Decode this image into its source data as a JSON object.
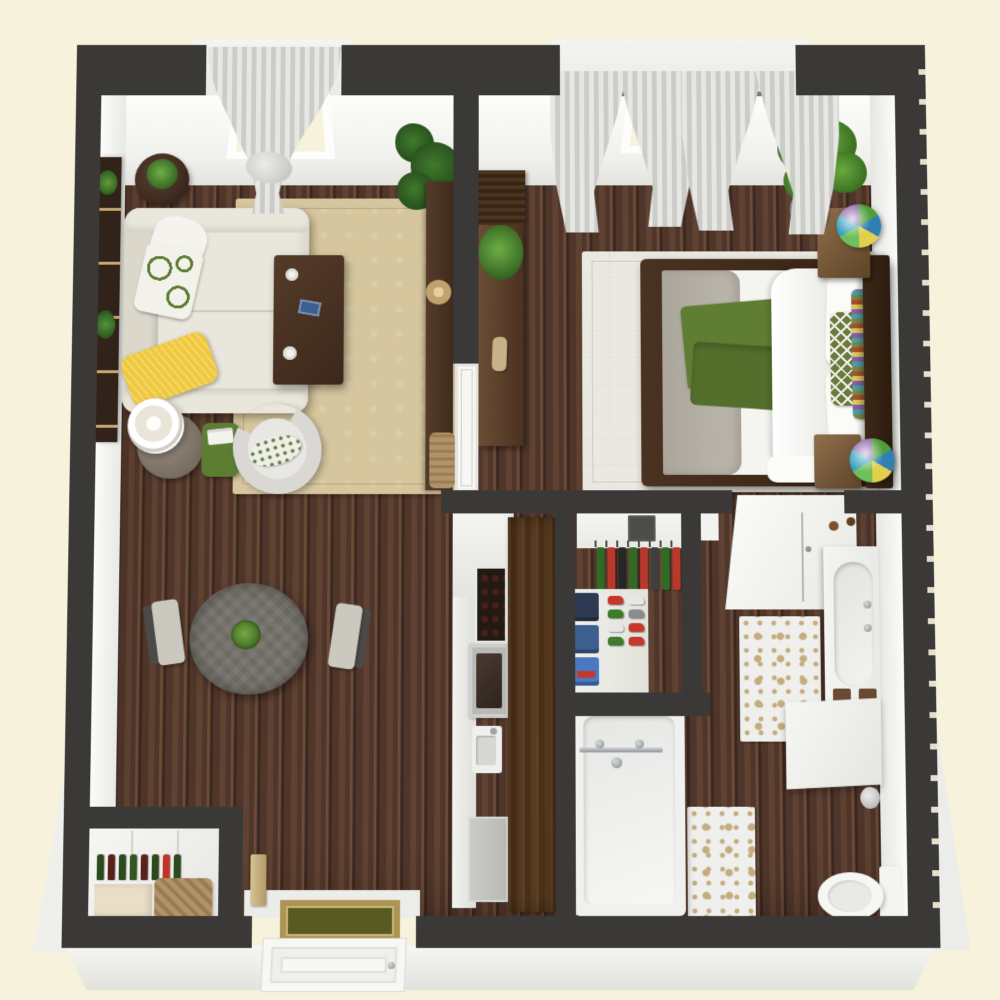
{
  "title": "One-bedroom apartment 3D floor plan",
  "scene": {
    "type": "3d-floor-plan",
    "view": "top-down perspective render",
    "rooms": [
      {
        "name": "living-room",
        "furniture": [
          "sofa",
          "coffee-table",
          "armchair",
          "floor-lamp",
          "lamp-side-table",
          "round-side-table",
          "bookshelf",
          "area-rug",
          "magazine-basket",
          "fiddle-leaf-plant",
          "console-table",
          "sheer-curtain-window"
        ]
      },
      {
        "name": "dining-area",
        "furniture": [
          "round-dining-table",
          "dining-chair-left",
          "dining-chair-right",
          "green-centerpiece-bowl"
        ]
      },
      {
        "name": "kitchen",
        "furniture": [
          "white-counter",
          "built-in-wine-cube",
          "range-oven",
          "sink",
          "dishwasher",
          "tall-wood-cabinets"
        ]
      },
      {
        "name": "bedroom",
        "furniture": [
          "bed",
          "headboard",
          "nightstand-top",
          "nightstand-bottom",
          "stained-glass-lamp-1",
          "stained-glass-lamp-2",
          "dresser",
          "slatted-cabinet",
          "palm-plant",
          "bedroom-rug",
          "double-curtained-window"
        ]
      },
      {
        "name": "walk-in-closet",
        "furniture": [
          "hanging-rod-clothes",
          "folded-stacks",
          "shoe-shelves",
          "wall-vent"
        ]
      },
      {
        "name": "bathroom",
        "furniture": [
          "shower-enclosure",
          "vanity-with-basin",
          "bathtub",
          "toilet",
          "damask-rug-upper",
          "damask-rug-lower",
          "waste-bin",
          "half-wall"
        ]
      },
      {
        "name": "entry",
        "furniture": [
          "front-door",
          "doormat",
          "pantry-closet",
          "wine-bottle-shelf",
          "storage-basket",
          "cream-storage-box",
          "key-holder"
        ]
      }
    ]
  },
  "palette": {
    "bg": "#f6f2dc",
    "wall": "#3a3937",
    "wood-1": "#50362a",
    "wood-2": "#5f4232",
    "wood-3": "#3b281f",
    "wood-4": "#6b4a38",
    "rug-living": "#d6c69e",
    "rug-bed": "#eae8e0",
    "bath-rug": "#eff0ed",
    "bath-rug-pat": "#c5ac7e",
    "sofa": "#e9e6db",
    "sofa-dark": "#dbd8cb",
    "yellow": "#efc83b",
    "accent-green": "#5d7d33",
    "throw-green": "#5f7d33",
    "olive": "#6b7a3c",
    "gray-table": "#75726a",
    "chair-gray": "#cbc8c0",
    "denim": "#3d5e91",
    "chrome": "#9fa4a6",
    "basket": "#b1926a",
    "cream-box": "#e9dfc6",
    "mat-border": "#ab9454",
    "mat-center": "#585a24",
    "label-red": "#c0392b"
  },
  "closet": {
    "hanging_items": [
      "#2f6b24",
      "#b9372b",
      "#262626",
      "#2f6b24",
      "#b9372b",
      "#3f3f3f",
      "#2f6b24",
      "#b9372b"
    ],
    "stacks": [
      "#2c3a52",
      "#3c5f8e",
      "#4a78c2"
    ],
    "shoes": [
      "#c8372e",
      "#e8e6e2",
      "#3f7a2e",
      "#8a8d90",
      "#e8e6e2",
      "#c8372e",
      "#3f7a2e",
      "#c8372e"
    ]
  },
  "pantry": {
    "bottles": [
      "#2c4a1e",
      "#5a211c",
      "#2c4a1e",
      "#33551f",
      "#5a211c",
      "#2c4a1e",
      "#c23327",
      "#2c4a1e"
    ]
  },
  "lamps": {
    "tiffany_colors": [
      "#4f9e3c",
      "#2f7fb5",
      "#e3cf4e",
      "#6ec05a",
      "#37a0c0",
      "#8a62a8"
    ]
  }
}
